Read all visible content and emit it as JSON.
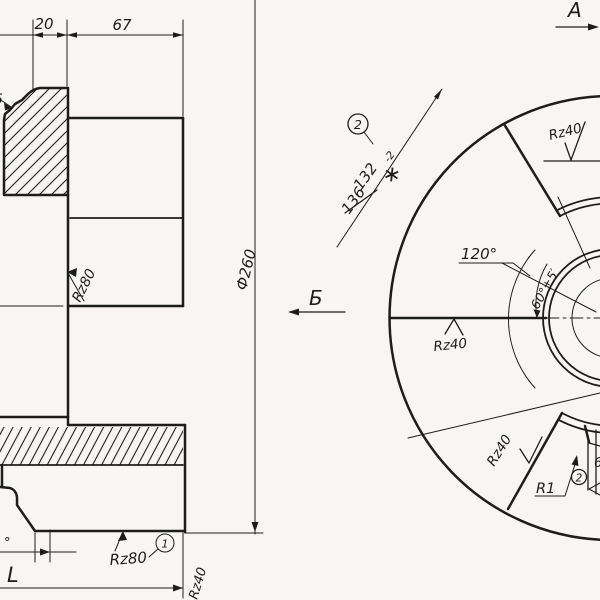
{
  "drawing_type": "engineering-drawing",
  "left_view": {
    "dim_width_20": "20",
    "dim_width_67": "67",
    "chamfer_label": "5",
    "surface_upper": "Rz80",
    "diameter": "Ф260",
    "surface_lower": "Rz80",
    "balloon_1": "1",
    "angle_fragment": "°",
    "length_fragment": "L",
    "surface_bottom": "Rz40"
  },
  "right_view": {
    "view_a": "A",
    "view_b": "Б",
    "balloon_2_top": "2",
    "dim_132": "132",
    "dim_132_tol": "-2",
    "dim_132_star": "∗",
    "dim_136_old": "136",
    "angle_120": "120°",
    "angle_60": "60°±5′",
    "surface_top": "Rz40",
    "surface_left": "Rz40",
    "surface_bottom": "Rz40",
    "radius_r1": "R1",
    "balloon_2_bottom": "2",
    "edge_fragment": "6"
  }
}
